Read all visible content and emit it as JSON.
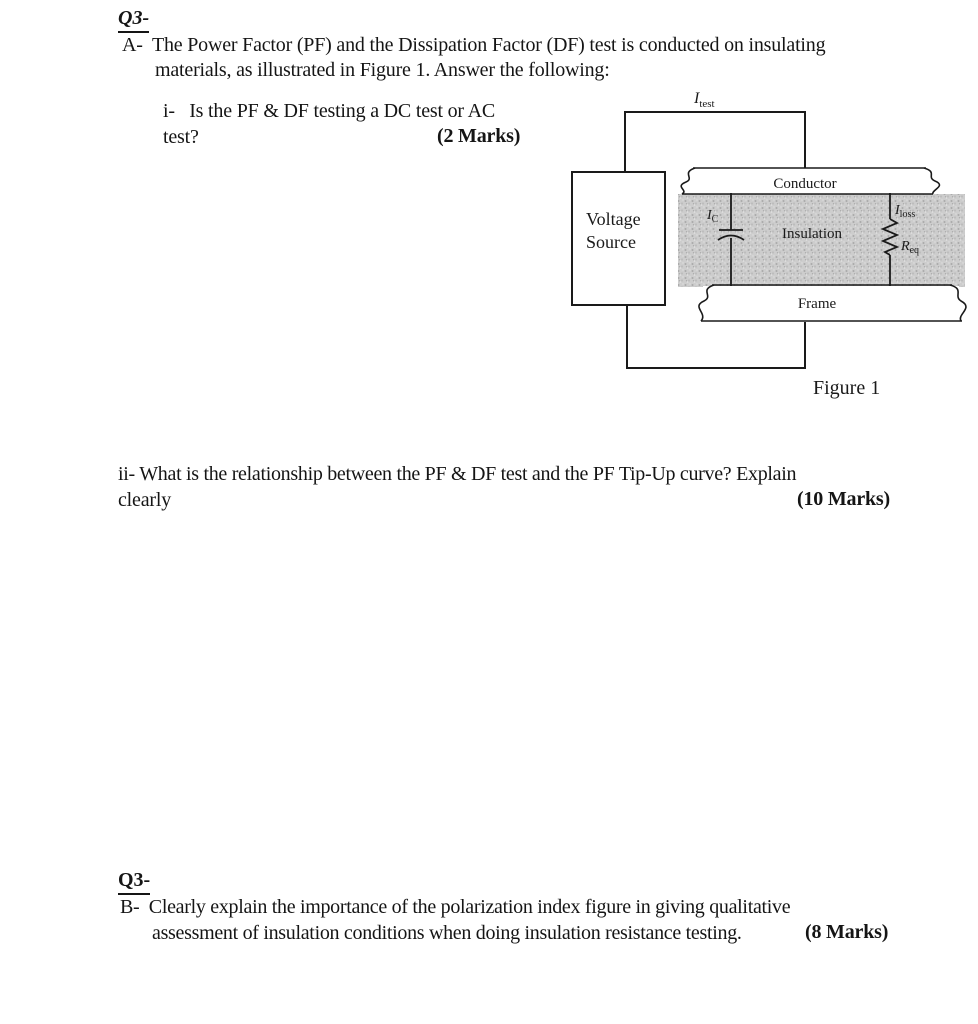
{
  "section_a": {
    "heading": "Q3-",
    "line1": "A-  The Power Factor (PF) and the Dissipation Factor (DF) test is conducted on insulating",
    "line2": "materials, as illustrated in Figure 1. Answer the following:"
  },
  "question_i": {
    "line1": "i-   Is the PF & DF testing a DC test or AC",
    "line2": "test?",
    "marks": "(2 Marks)"
  },
  "figure": {
    "i_test": {
      "main": "I",
      "sub": "test"
    },
    "voltage_source": {
      "line1": "Voltage",
      "line2": "Source"
    },
    "conductor": "Conductor",
    "insulation": "Insulation",
    "frame": "Frame",
    "i_c": {
      "main": "I",
      "sub": "C"
    },
    "i_loss": {
      "main": "I",
      "sub": "loss"
    },
    "r_eq": {
      "main": "R",
      "sub": "eq"
    },
    "caption": "Figure 1",
    "colors": {
      "ink": "#1a1a1a",
      "insulation_fill": "#cdcdcd"
    }
  },
  "question_ii": {
    "line1": "ii- What is the relationship between the PF & DF test and the PF Tip-Up curve? Explain",
    "line2": "clearly",
    "marks": "(10 Marks)"
  },
  "section_b": {
    "heading": "Q3-",
    "line1": "B-  Clearly explain the importance of the polarization index figure in giving qualitative",
    "line2": "assessment of insulation conditions when doing insulation resistance testing.",
    "marks": "(8 Marks)"
  }
}
